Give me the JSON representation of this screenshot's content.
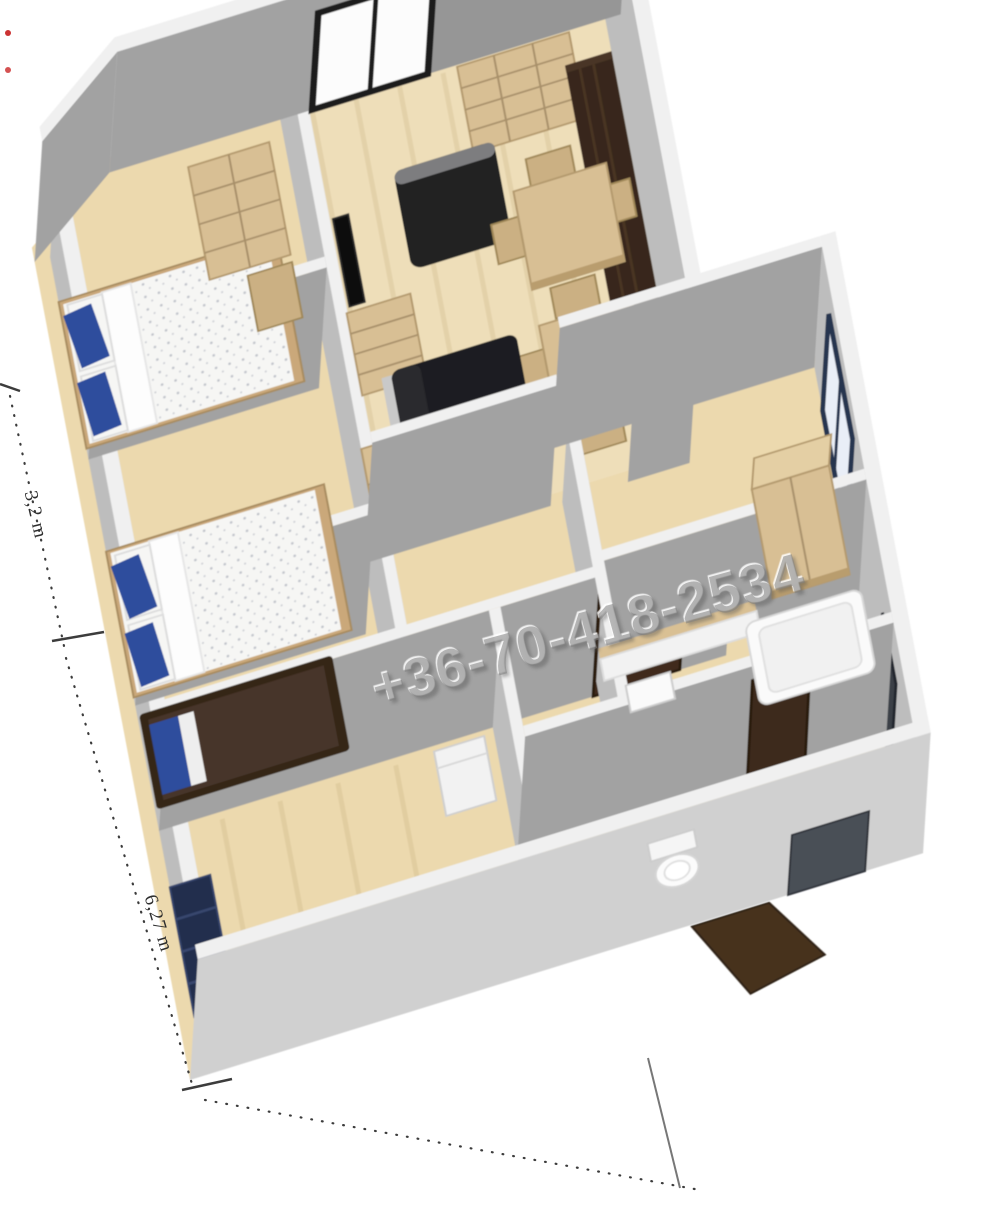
{
  "watermark": {
    "text": "+36-70-418-2534"
  },
  "labels": {
    "living_room": "Nappali",
    "kitchen": "Konyha"
  },
  "dimensions": {
    "side_a": "3,2 m",
    "side_b": "6,27 m"
  },
  "colors": {
    "background": "#ffffff",
    "floor": "#ecd9ae",
    "wall_face": "#a2a2a2",
    "wall_face_light": "#bdbdbd",
    "wall_top": "#f0f0f0",
    "wood_furniture": "#d8bf94",
    "dark_wardrobe": "#38281b",
    "interior_door": "#3f2c1e",
    "front_door": "#46311f",
    "sofa_black": "#1f1f21",
    "pillow_blue": "#2e4d9d",
    "bedding_white": "#f6f6f4",
    "navy_shelf": "#222d4d",
    "dimension_ink": "#2e2e2e",
    "watermark_gray": "#808080",
    "marker_red": "#cc3333"
  }
}
